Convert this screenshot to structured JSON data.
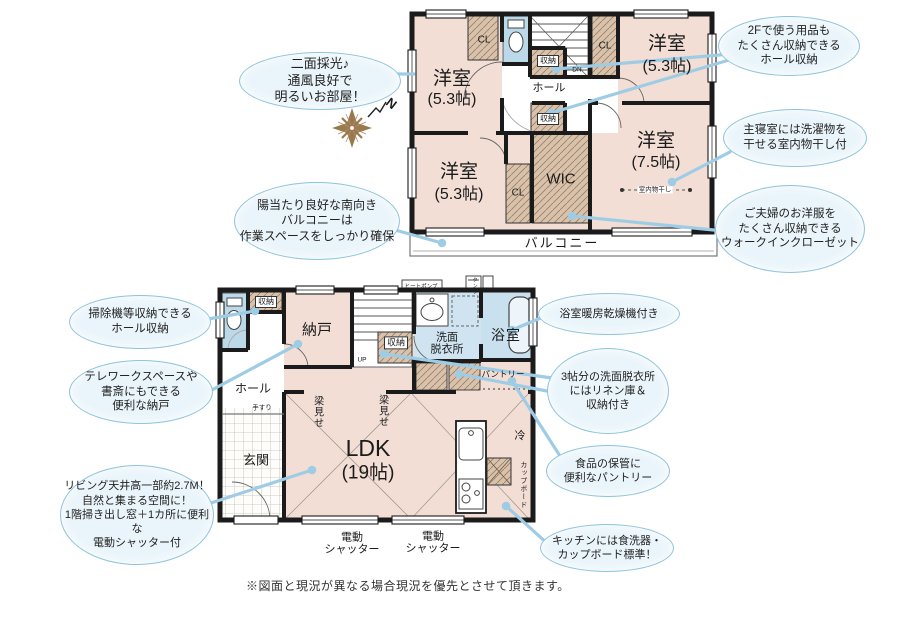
{
  "callouts": [
    {
      "id": "light",
      "text": "二面採光♪\n通風良好で\n明るいお部屋！"
    },
    {
      "id": "hall-storage-2f",
      "text": "2Fで使う用品も\nたくさん収納できる\nホール収納"
    },
    {
      "id": "indoor-drying",
      "text": "主寝室には洗濯物を\n干せる室内物干し付"
    },
    {
      "id": "wic",
      "text": "ご夫婦のお洋服を\nたくさん収納できる\nウォークインクローゼット"
    },
    {
      "id": "balcony",
      "text": "陽当たり良好な南向き\nバルコニーは\n作業スペースをしっかり確保"
    },
    {
      "id": "hall-storage-1f",
      "text": "掃除機等収納できる\nホール収納"
    },
    {
      "id": "nando",
      "text": "テレワークスペースや\n書斎にもできる\n便利な納戸"
    },
    {
      "id": "bath-dryer",
      "text": "浴室暖房乾燥機付き"
    },
    {
      "id": "washroom",
      "text": "3帖分の洗面脱衣所\nにはリネン庫＆\n収納付き"
    },
    {
      "id": "pantry",
      "text": "食品の保管に\n便利なパントリー"
    },
    {
      "id": "kitchen",
      "text": "キッチンには食洗器・\nカップボード標準！"
    },
    {
      "id": "living",
      "text": "リビング天井高一部約2.7M！\n自然と集まる空間に！\n1階掃き出し窓＋1カ所に便利な\n電動シャッター付"
    }
  ],
  "floor2": {
    "room_nw": {
      "name": "洋室",
      "size": "(5.3帖)"
    },
    "room_ne": {
      "name": "洋室",
      "size": "(5.3帖)"
    },
    "room_sw": {
      "name": "洋室",
      "size": "(5.3帖)"
    },
    "room_se": {
      "name": "洋室",
      "size": "(7.5帖)"
    },
    "wic": "WIC",
    "cl_nw": "CL",
    "cl_ne": "CL",
    "cl_sw": "CL",
    "storage_top": "収納",
    "storage_mid": "収納",
    "hall": "ホール",
    "dn": "DN",
    "monohoshi": "室内物干し",
    "balcony": "バルコニー"
  },
  "floor1": {
    "nando": "納戸",
    "storage_hall": "収納",
    "storage_stairs": "収納",
    "senmen": "洗面\n脱衣所",
    "bath": "浴室",
    "pantry": "パントリー",
    "hall": "ホール",
    "tesuri": "手すり",
    "genkan": "玄関",
    "ldk": {
      "name": "LDK",
      "size": "(19帖)"
    },
    "hari_1": "梁見せ",
    "hari_2": "梁見せ",
    "rei": "冷",
    "cupboard": "カップボード",
    "up": "UP",
    "heatpump": "ヒートポンプ",
    "tank": "タンク",
    "shutter_1": "電動\nシャッター",
    "shutter_2": "電動\nシャッター"
  },
  "compass": {
    "north": "N"
  },
  "footer": {
    "disclaimer": "※図面と現況が異なる場合現況を優先とさせて頂きます。"
  },
  "colors": {
    "room_fill": "#f2ded5",
    "closet_fill": "#d9c2ac",
    "wet_fill": "#bcd9e9",
    "wall": "#1b1b1b",
    "callout_fill": "#eaf5fb",
    "callout_border": "#8fc3dc",
    "connector": "#9fcce5",
    "compass": "#9a7950"
  }
}
